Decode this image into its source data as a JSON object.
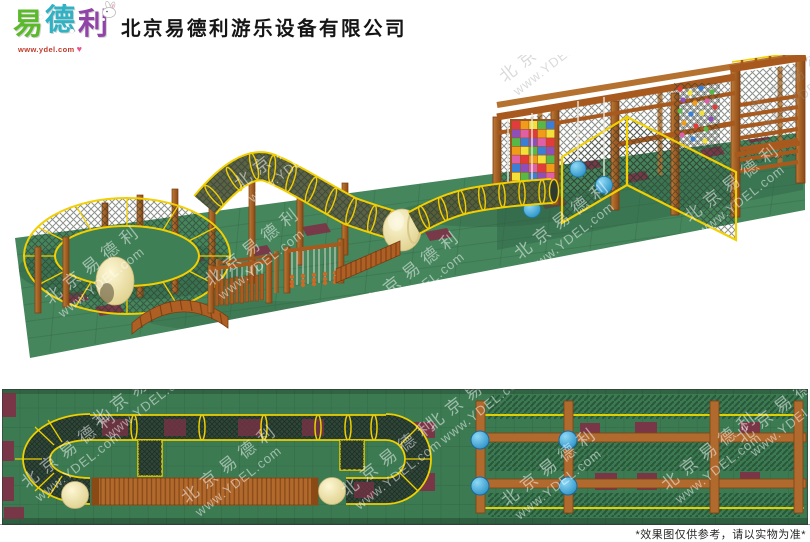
{
  "header": {
    "logo": {
      "chars": [
        {
          "text": "易",
          "color": "#5bb92c"
        },
        {
          "text": "德",
          "color": "#2fb3c4"
        },
        {
          "text": "利",
          "color": "#9044a8"
        }
      ],
      "url": "www.ydel.com",
      "heart": "♥",
      "mascot": "rabbit"
    },
    "company_name": "北京易德利游乐设备有限公司"
  },
  "watermark": {
    "cn": "北京易德利",
    "url": "www.YDEL.com"
  },
  "footer": {
    "disclaimer": "*效果图仅供参考，请以实物为准*"
  },
  "palette": {
    "floor_green": "#45865c",
    "plan_green": "#3c7a52",
    "tile_maroon": "#7e3146",
    "rope_yellow": "#f2cf00",
    "wood_brown": "#a85c20",
    "wood_dark": "#7a3c12",
    "net_dark": "#31463a",
    "egg_cream": "#f2e7b1",
    "ball_blue": "#35a8dc",
    "logo_green": "#5bb92c",
    "logo_cyan": "#2fb3c4",
    "logo_purple": "#9044a8",
    "heart_pink": "#ef4f8a"
  }
}
